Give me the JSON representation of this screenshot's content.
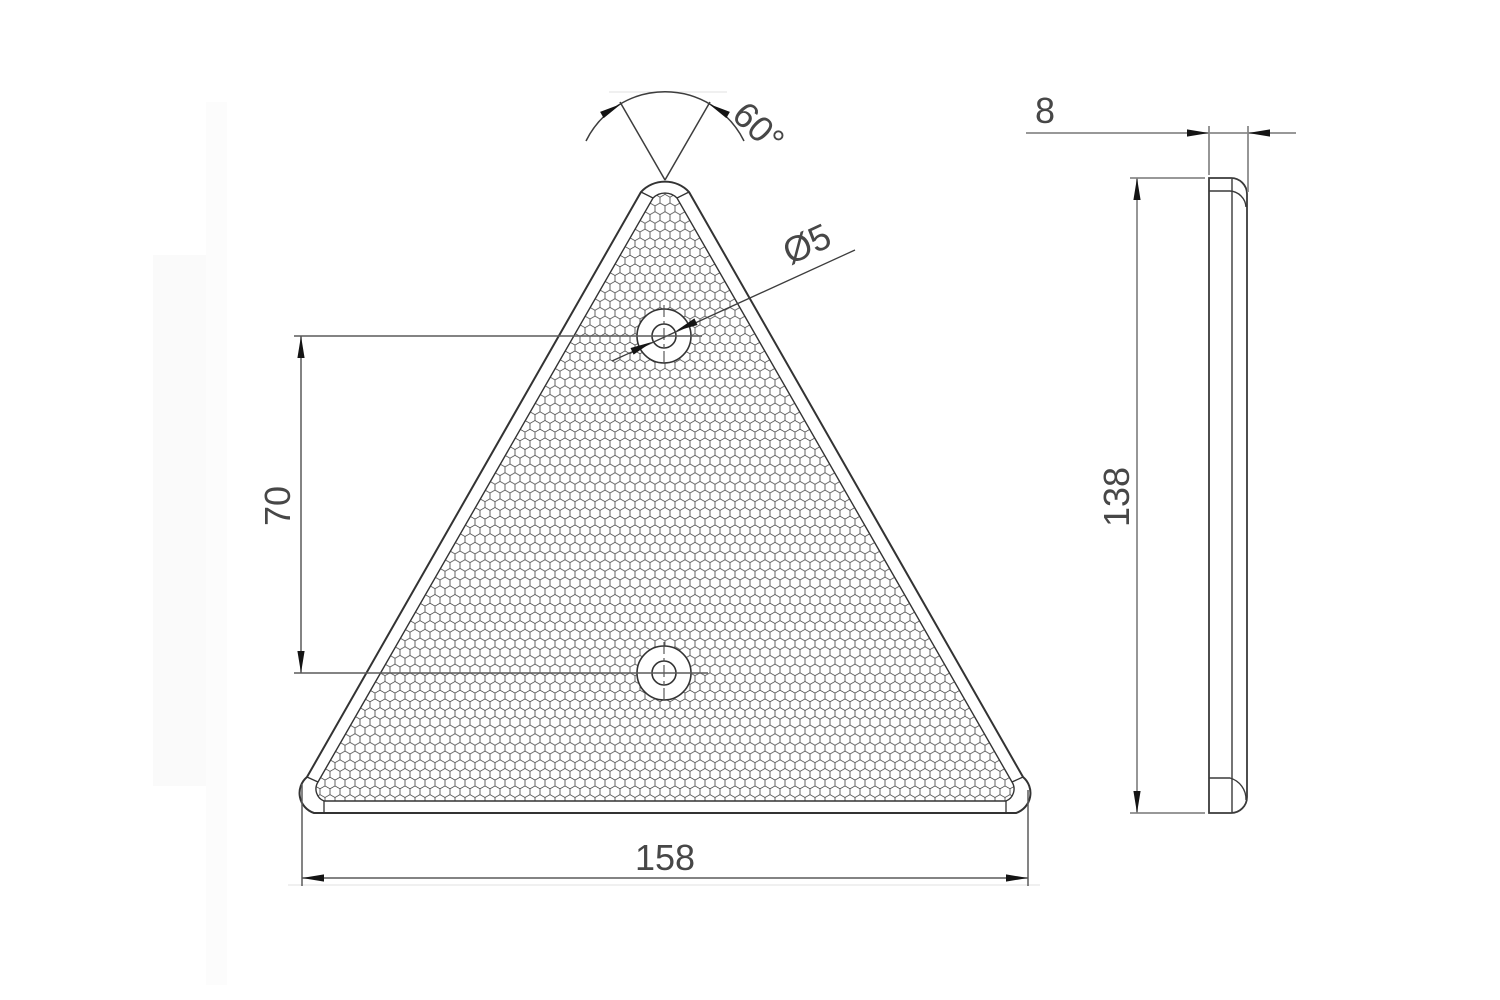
{
  "drawing_title": "Triangular reflector - two-view technical drawing",
  "colors": {
    "background": "#ffffff",
    "outline": "#333333",
    "dimension_front": "#5a5a5a",
    "dimension_side": "#8a8a8a",
    "arrow": "#141414",
    "text": "#474747"
  },
  "dimensions": {
    "apex_angle": "60°",
    "hole_diameter": "Ø5",
    "hole_spacing": "70",
    "base_width": "158",
    "thickness": "8",
    "height": "138"
  }
}
